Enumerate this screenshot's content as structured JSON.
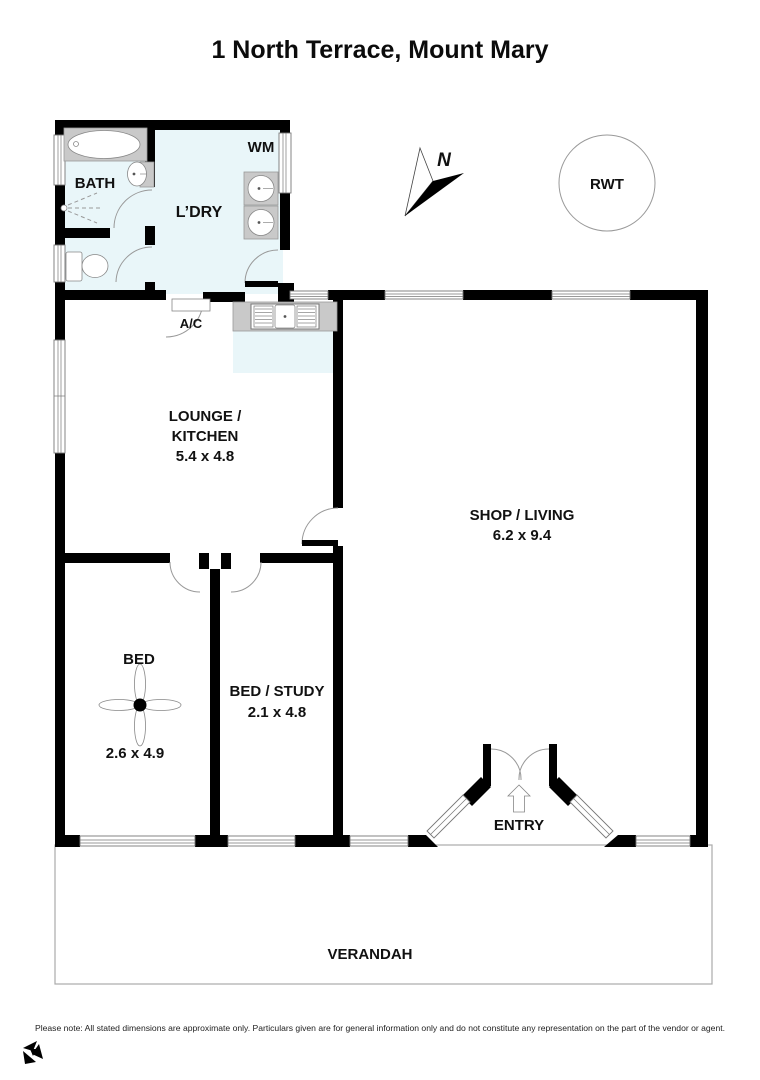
{
  "title": "1 North Terrace, Mount Mary",
  "compass": {
    "north_label": "N"
  },
  "water_tank": {
    "label": "RWT"
  },
  "rooms": {
    "bath": {
      "name": "BATH"
    },
    "laundry": {
      "name": "L’DRY",
      "washing_machine_label": "WM"
    },
    "ac_unit": {
      "label": "A/C"
    },
    "lounge_kitchen": {
      "name_line1": "LOUNGE /",
      "name_line2": "KITCHEN",
      "dimensions": "5.4 x 4.8"
    },
    "shop_living": {
      "name": "SHOP / LIVING",
      "dimensions": "6.2 x 9.4"
    },
    "bed": {
      "name": "BED",
      "dimensions": "2.6 x 4.9"
    },
    "bed_study": {
      "name": "BED / STUDY",
      "dimensions": "2.1 x 4.8"
    },
    "entry": {
      "label": "ENTRY"
    },
    "verandah": {
      "name": "VERANDAH"
    }
  },
  "footer": {
    "disclaimer": "Please note: All stated dimensions are approximate only. Particulars given are for general information only and do not constitute any representation on the part of the vendor or agent."
  },
  "colors": {
    "wall": "#000000",
    "fixture_gray": "#c9c9c9",
    "floor_tint": "#e9f6f9",
    "line": "#777777"
  }
}
